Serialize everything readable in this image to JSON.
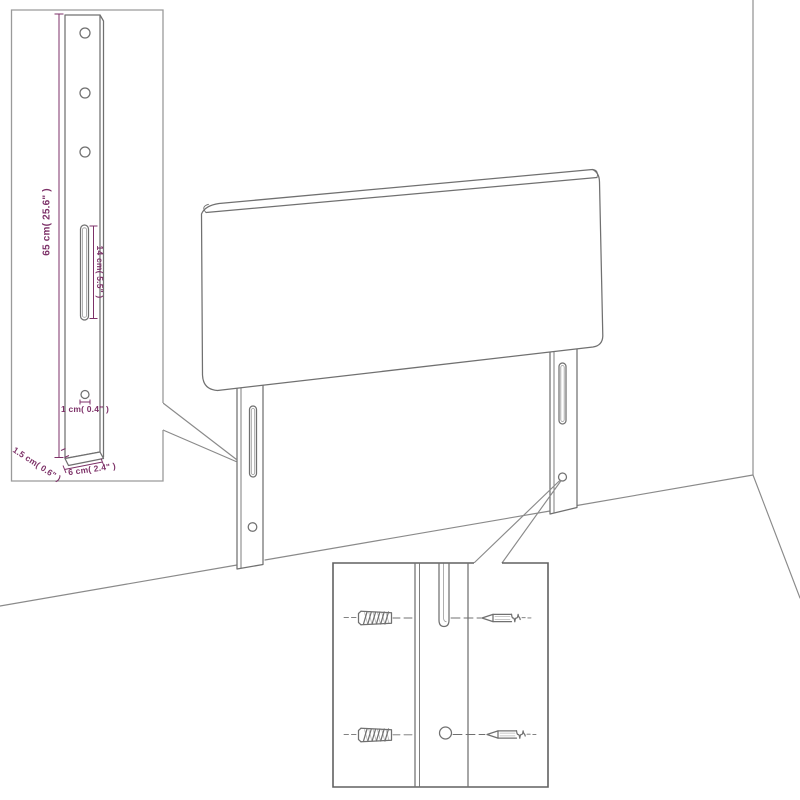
{
  "labels": {
    "height": "65 cm( 25.6\" )",
    "slot_length": "14 cm( 5.5\" )",
    "hole_diameter": "1 cm( 0.4\" )",
    "thickness": "1.5 cm( 0.6\" )",
    "leg_width": "6 cm( 2.4\" )"
  },
  "colors": {
    "dimension": "#7d3168",
    "line": "#707070",
    "wall": "#8a8a8a",
    "inset_border_light": "#9a9a9a",
    "inset_border_dark": "#606060",
    "background": "#ffffff"
  }
}
